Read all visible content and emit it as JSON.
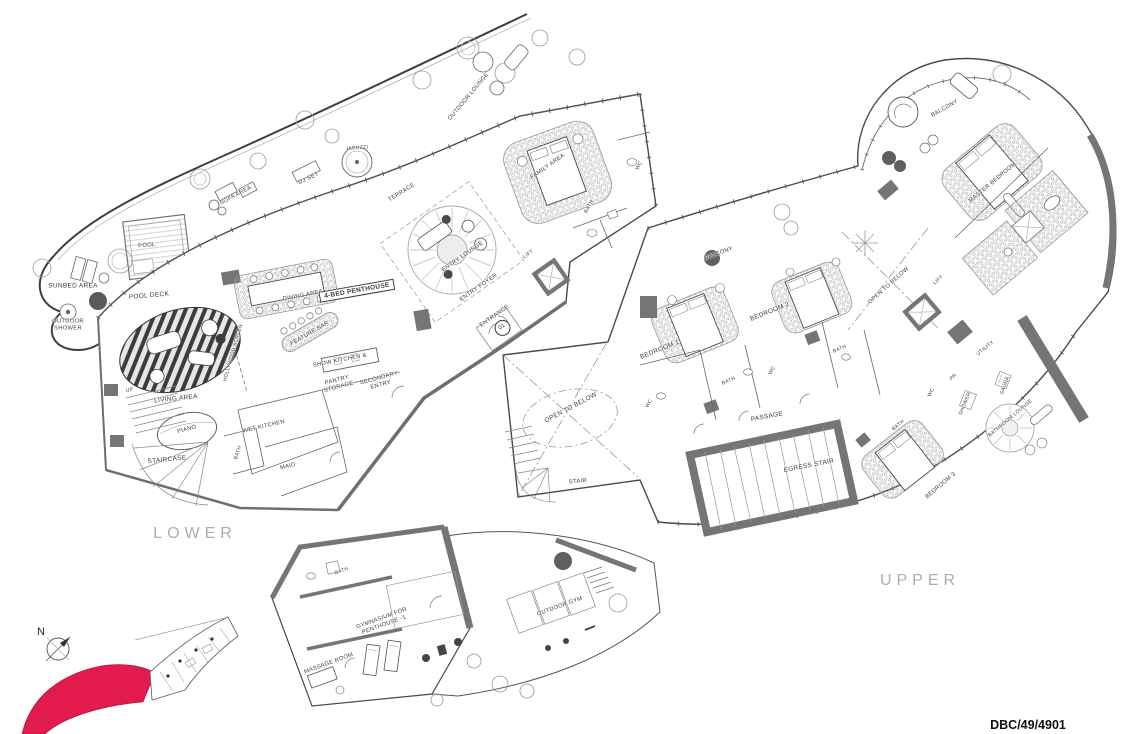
{
  "sheet": {
    "type": "penthouse floor plan drawing",
    "accent_red": "#e31b4c",
    "line_color": "#4a4a4a",
    "wall_color": "#757575"
  },
  "title_block": {
    "drawing_ref": "DBC/49/4901"
  },
  "key_plan": {
    "north_label": "N"
  },
  "floor_labels": {
    "lower": "LOWER",
    "upper": "UPPER"
  },
  "rooms": {
    "unit_tag": "4-BED PENTHOUSE",
    "outdoor_lounge": "OUTDOOR LOUNGE",
    "jacuzzi": "JACUZZI",
    "dj_set": "DJ SET",
    "sofa_area": "SOFA AREA",
    "terrace": "TERRACE",
    "pool": "POOL",
    "pool_deck": "POOL DECK",
    "sunbed_area": "SUNBED AREA",
    "outdoor_shower_1": "OUTDOOR",
    "outdoor_shower_2": "SHOWER",
    "dining_area": "DINING AREA",
    "feature_bar": "FEATURE BAR",
    "show_kitchen": "SHOW KITCHEN &",
    "pantry_1": "PANTRY",
    "pantry_2": "STORAGE",
    "secondary_1": "SECONDARY",
    "secondary_2": "ENTRY",
    "wet_kitchen": "WET KITCHEN",
    "maid": "MAID",
    "bath": "BATH",
    "wc": "WC",
    "living_area": "LIVING AREA",
    "piano": "PIANO",
    "staircase": "STAIRCASE",
    "up": "UP",
    "hollywood_screen": "HOLLYWOOD SCREEN",
    "family_area": "FAMILY AREA",
    "lift": "LIFT",
    "entry_lounge": "ENTRY LOUNGE",
    "entry_foyer": "ENTRY FOYER",
    "entrance": "ENTRANCE",
    "entrance_no": "01",
    "balcony": "BALCONY",
    "bedroom_1": "BEDROOM 1",
    "bedroom_2": "BEDROOM 2",
    "bedroom_3": "BEDROOM 3",
    "master_bedroom": "MASTER BEDROOM",
    "open_to_below": "OPEN TO BELOW",
    "stair": "STAIR",
    "passage": "PASSAGE",
    "egress_stair": "EGRESS STAIR",
    "utility": "UTILITY",
    "pr": "PR",
    "shower": "SHOWER",
    "sauna": "SAUNA",
    "bathroom_lounge": "BATHROOM LOUNGE",
    "massage_room": "MASSAGE ROOM",
    "gymnasium_1": "GYMNASIUM FOR",
    "gymnasium_2": "PENTHOUSE -1",
    "outdoor_gym": "OUTDOOR GYM"
  }
}
